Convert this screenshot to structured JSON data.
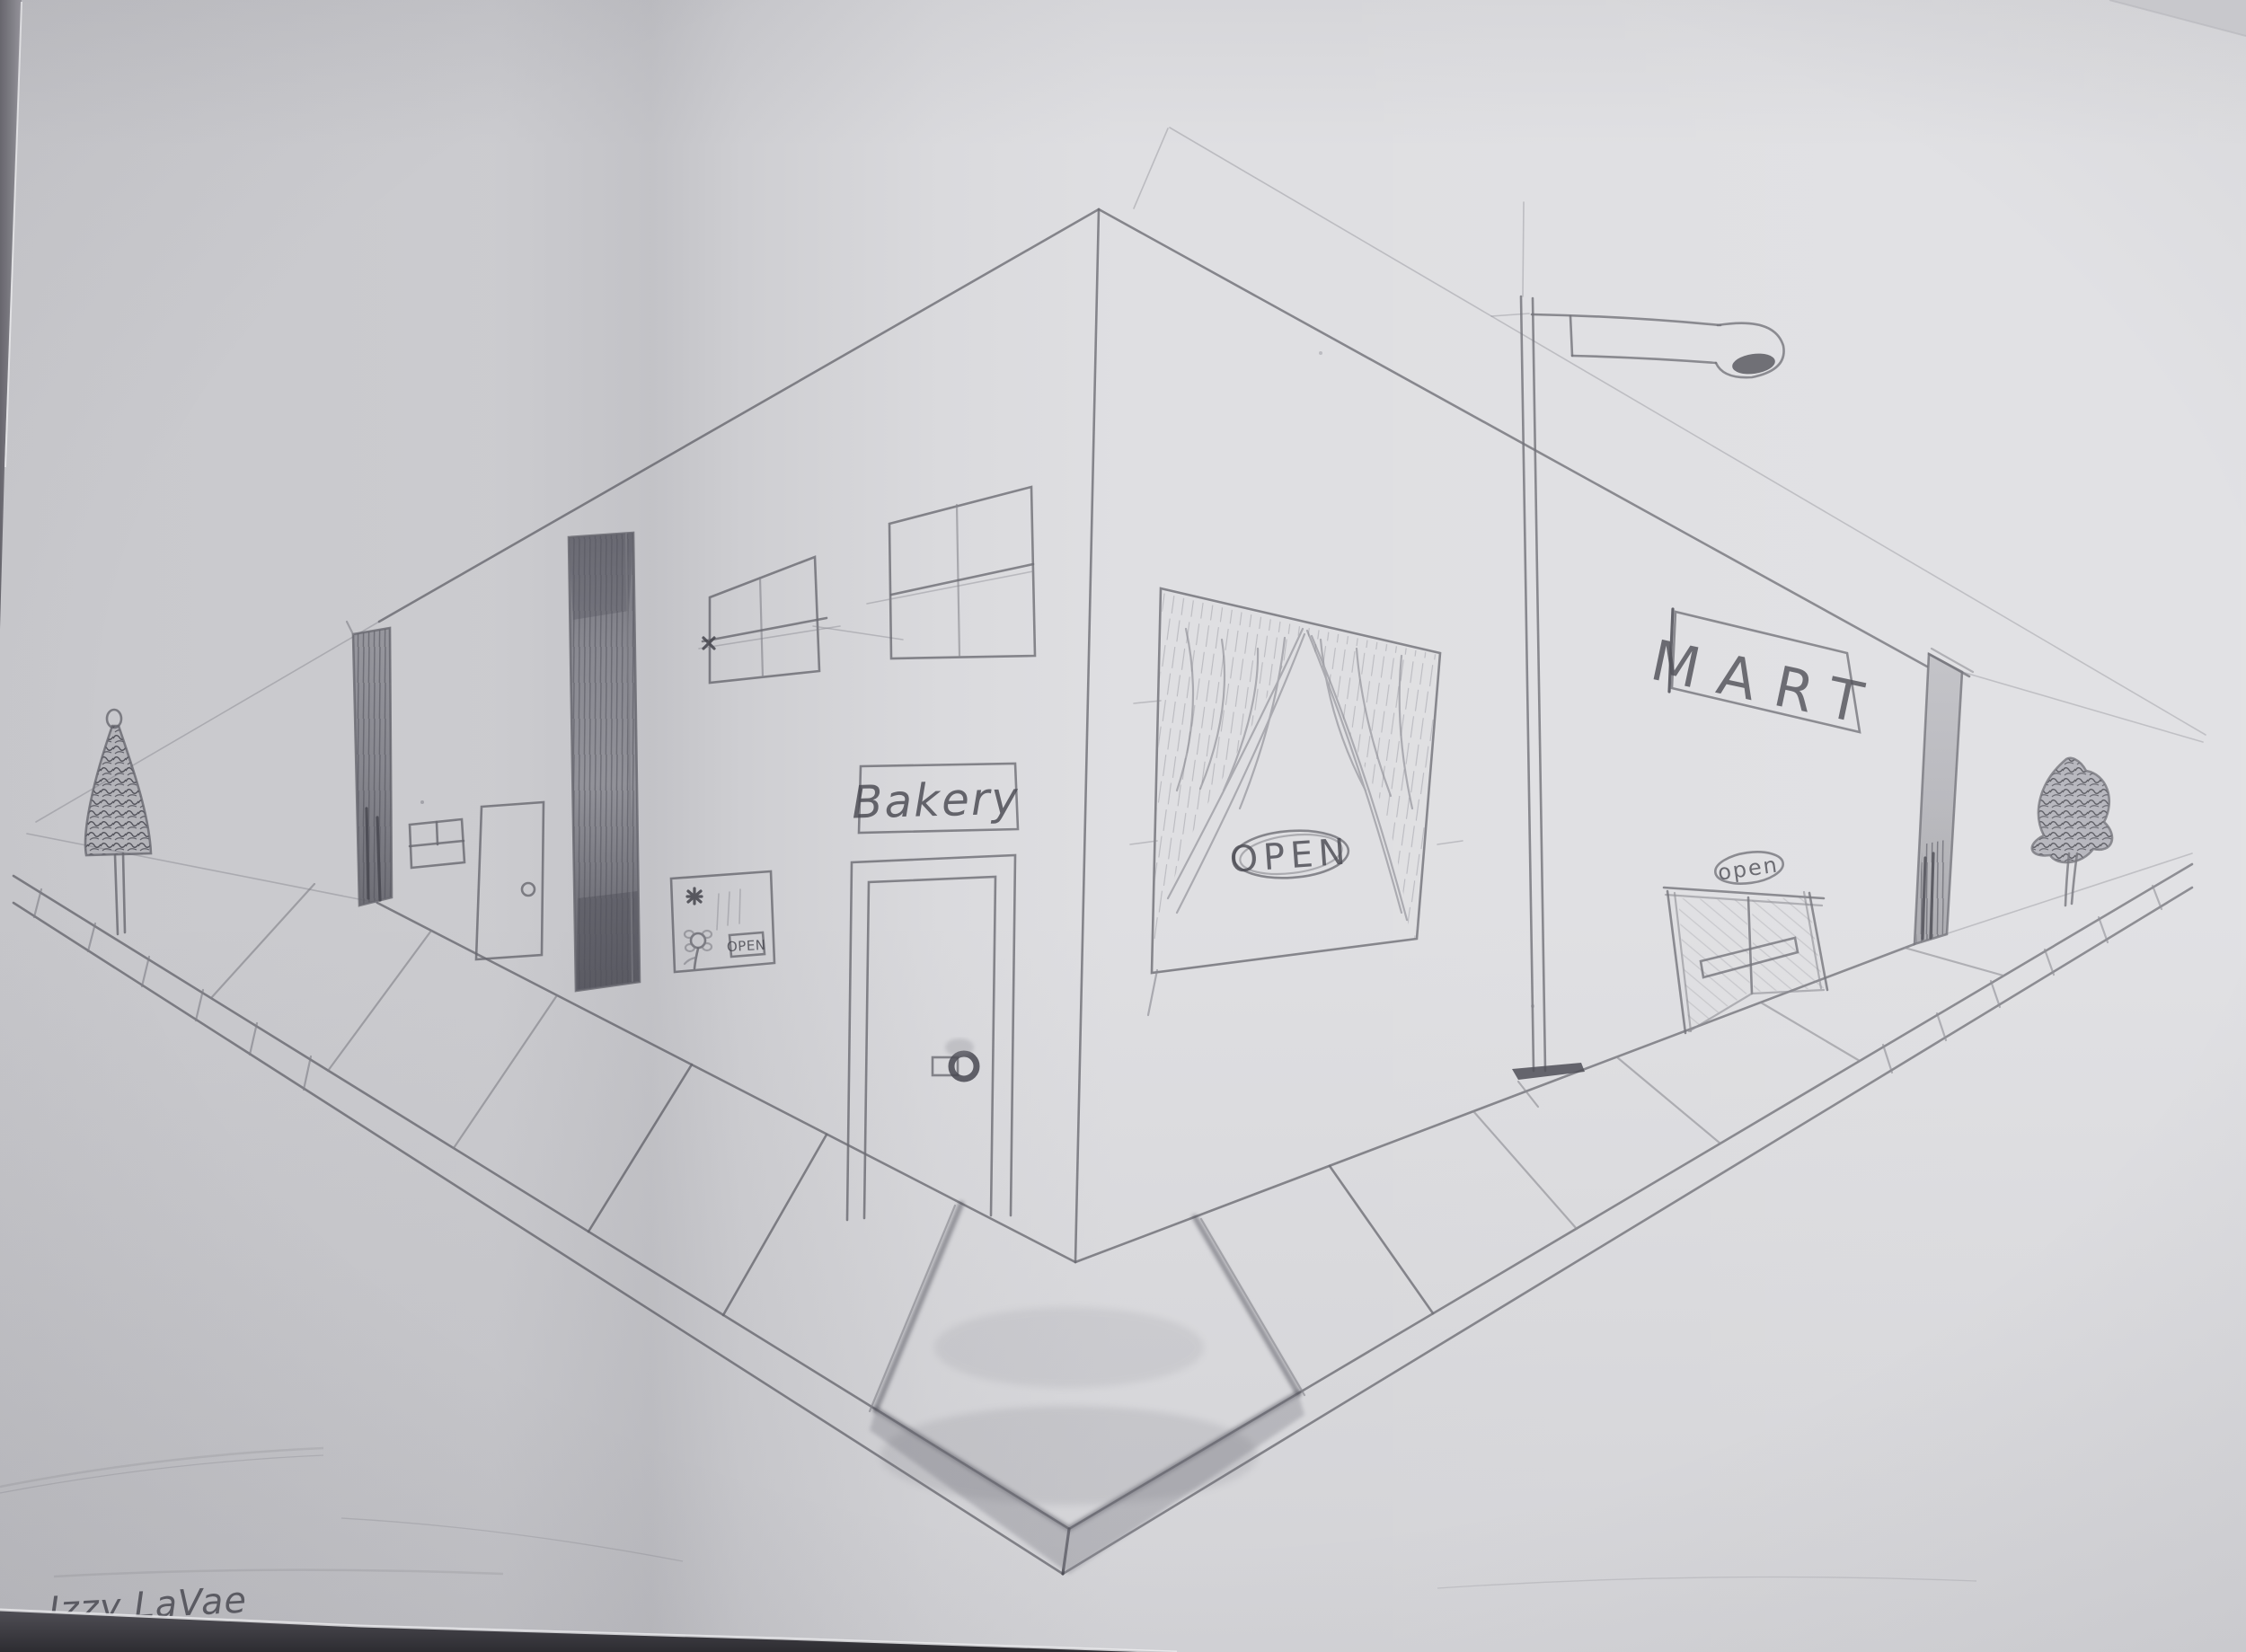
{
  "texts": {
    "bakery_sign": "Bakery",
    "bakery_window_open": "OPEN",
    "left_shop_open_plaque": "OPEN",
    "mart_sign": "MART",
    "mart_open": "open",
    "signature": "Izzy LaVae"
  },
  "colors": {
    "paper": "#dfdfe2",
    "pencil_light": "#8b8b92",
    "pencil_medium": "#6e6e76",
    "pencil_dark": "#4a4a52",
    "table_dark": "#39383d"
  }
}
